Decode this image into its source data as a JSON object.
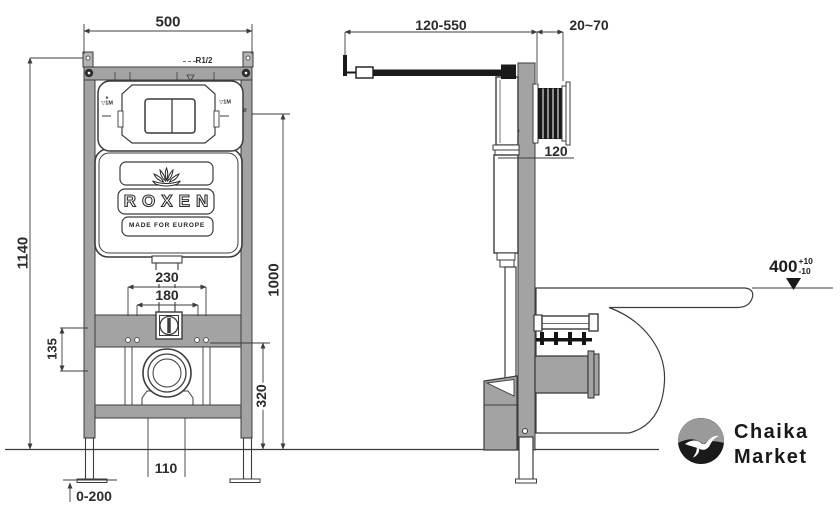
{
  "meta": {
    "title": "Roxen wall-hung toilet installation frame technical drawing",
    "colors": {
      "frame_gray": "#a3a3a3",
      "line": "#3c3c3c",
      "black": "#161616",
      "text": "#2b2b2b"
    }
  },
  "front": {
    "dim_500": "500",
    "dim_1140": "1140",
    "dim_135": "135",
    "dim_230": "230",
    "dim_180": "180",
    "dim_1000": "1000",
    "dim_320": "320",
    "dim_110": "110",
    "dim_leg_adjust": "0-200",
    "inlet_label": "R1/2",
    "plate_mark_top": "▲",
    "plate_mark": "▽1M",
    "rail_mark": "N",
    "brand": "ROXEN",
    "made_for": "MADE FOR EUROPE"
  },
  "side": {
    "dim_depth_range": "120-550",
    "dim_wall_range": "20~70",
    "dim_120": "120",
    "dim_seat_height": "400",
    "tol_plus": "+10",
    "tol_minus": "-10"
  },
  "logo": {
    "line1": "Chaika",
    "line2": "Market"
  }
}
